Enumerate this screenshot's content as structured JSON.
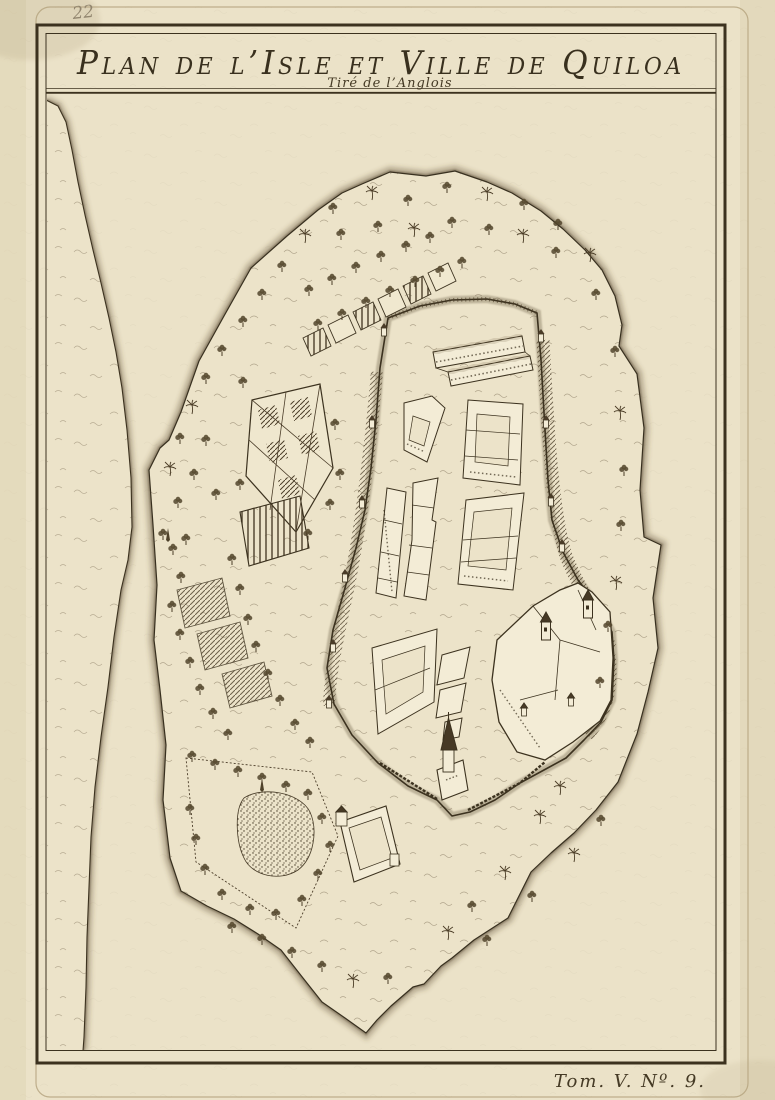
{
  "plate": {
    "title": "Plan de l’Isle et Ville de Quiloa",
    "subtitle": "Tiré de l’Anglois",
    "tome_ref": "Tom. V. Nº. 9.",
    "handwritten_number": "22"
  },
  "colors": {
    "paper": "#ebe2c8",
    "ink": "#3c321f",
    "line_brown": "#4a3c28",
    "pencil_gray": "#92866f"
  }
}
